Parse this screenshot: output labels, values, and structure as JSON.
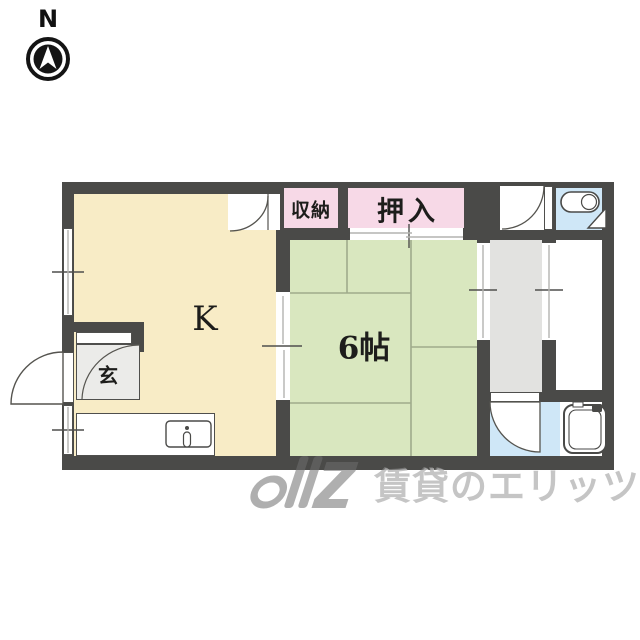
{
  "compass": {
    "label": "N"
  },
  "plan": {
    "wall_color": "#4a4a48",
    "rooms": {
      "kitchen": {
        "label": "K",
        "color": "#f8ecc6"
      },
      "tatami_room": {
        "label": "6帖",
        "color": "#d9e7bf"
      },
      "storage": {
        "label": "収納",
        "color": "#f7d9e7"
      },
      "closet": {
        "label": "押入",
        "color": "#f7d9e7"
      },
      "entrance": {
        "label": "玄",
        "color": "#ebebe9"
      },
      "corridor": {
        "color": "#e2e2e0"
      },
      "toilet": {
        "color": "#cfe7f7"
      },
      "bathroom": {
        "color": "#cfe7f7"
      }
    },
    "icons": {
      "north_arrow": "north-arrow-icon",
      "toilet": "toilet-icon",
      "bathtub": "bathtub-icon",
      "sink": "kitchen-sink-icon",
      "doors": "door-swing-arc"
    }
  },
  "watermark": {
    "text": "賃貸のエリッツ"
  }
}
